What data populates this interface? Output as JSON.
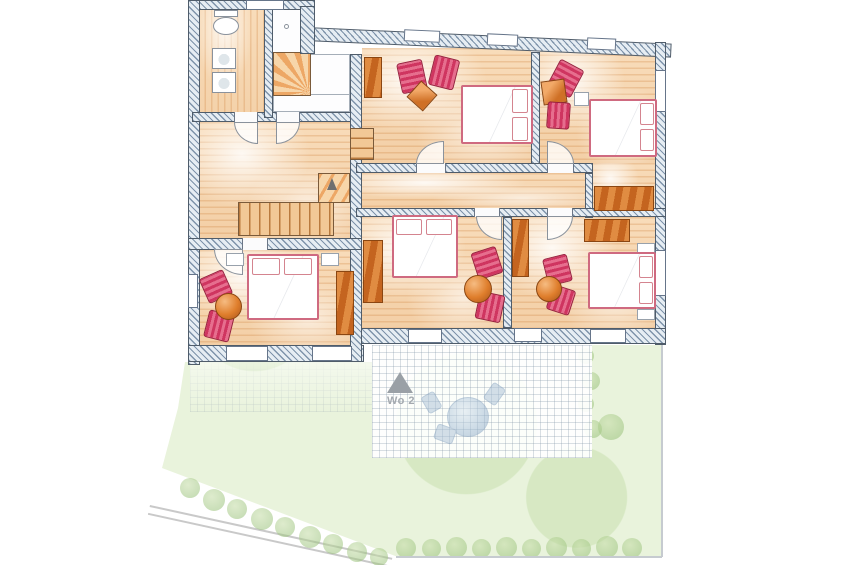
{
  "floor_plan": {
    "terrace_marker": {
      "label": "Wo 2",
      "symbol": "triangle-up-icon",
      "color": "#9aa0a6"
    },
    "rooms": [
      {
        "id": "bathroom",
        "fixtures": [
          "toilet",
          "washbasin",
          "washbasin",
          "shower"
        ]
      },
      {
        "id": "hallway-landing",
        "fixtures": [
          "main-staircase",
          "winder-staircase",
          "connecting-steps",
          "direction-arrow"
        ]
      },
      {
        "id": "bedroom-north-middle",
        "furniture": [
          "double-bed",
          "armchair",
          "armchair",
          "square-side-table",
          "wardrobe"
        ]
      },
      {
        "id": "bedroom-north-east",
        "furniture": [
          "double-bed",
          "armchair",
          "armchair",
          "square-side-table",
          "nightstand"
        ]
      },
      {
        "id": "corridor",
        "furniture": [
          "wardrobe",
          "wardrobe"
        ]
      },
      {
        "id": "bedroom-south-west",
        "furniture": [
          "double-bed",
          "armchair",
          "armchair",
          "round-table",
          "wardrobe",
          "nightstand",
          "nightstand"
        ]
      },
      {
        "id": "bedroom-south-middle",
        "furniture": [
          "double-bed",
          "armchair",
          "armchair",
          "round-table",
          "wardrobe"
        ]
      },
      {
        "id": "bedroom-south-east",
        "furniture": [
          "double-bed",
          "armchair",
          "armchair",
          "round-table",
          "wardrobe",
          "nightstand",
          "nightstand"
        ]
      }
    ],
    "outdoor": {
      "terrace": {
        "patio_furniture": [
          "round-table",
          "chair",
          "chair",
          "chair"
        ]
      },
      "garden": {
        "features": [
          "lawn",
          "bushes",
          "hedge-row",
          "path"
        ]
      }
    },
    "colors": {
      "wall_hatch": "#7e93aa",
      "wall_fill": "#e6edf3",
      "wall_outline": "#4f5c6a",
      "floor_wood": "#f8dcba",
      "floor_plank_line": "#cf8a4b",
      "furniture_red": "#cf3560",
      "furniture_orange": "#df7e2c",
      "bed_trim": "#cf6a80",
      "garden_green": "#e9f3dc",
      "bush_green": "#9dc47e",
      "terrace_grid": "#8296a5",
      "marker_gray": "#9aa0a6",
      "patio_blue": "#9db8d2"
    }
  }
}
